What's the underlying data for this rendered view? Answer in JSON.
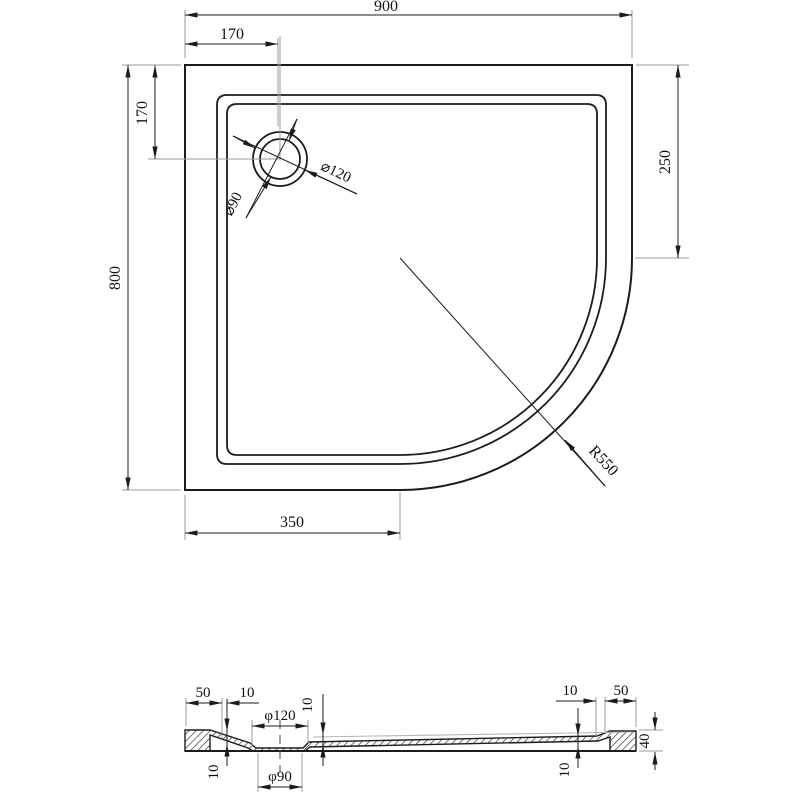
{
  "drawing_type": "technical-dimension-drawing",
  "subject": "quadrant shower tray, plan view and cross-section",
  "plan": {
    "width": "900",
    "drain_offset_x": "170",
    "drain_offset_y": "170",
    "depth": "800",
    "right_straight_edge": "250",
    "bottom_straight_edge": "350",
    "corner_radius": "R550",
    "drain_outer_dia": "⌀120",
    "drain_inner_dia": "⌀90"
  },
  "section": {
    "left_rim_width": "50",
    "left_step": "10",
    "drain_top_dia": "φ120",
    "drain_bottom_dia": "φ90",
    "left_depth": "10",
    "center_depth": "10",
    "right_step": "10",
    "right_rim_width": "50",
    "right_depth": "10",
    "total_height": "40"
  },
  "colors": {
    "line": "#1c1c1c",
    "extension_line": "#9b9b9b",
    "background": "#ffffff"
  }
}
